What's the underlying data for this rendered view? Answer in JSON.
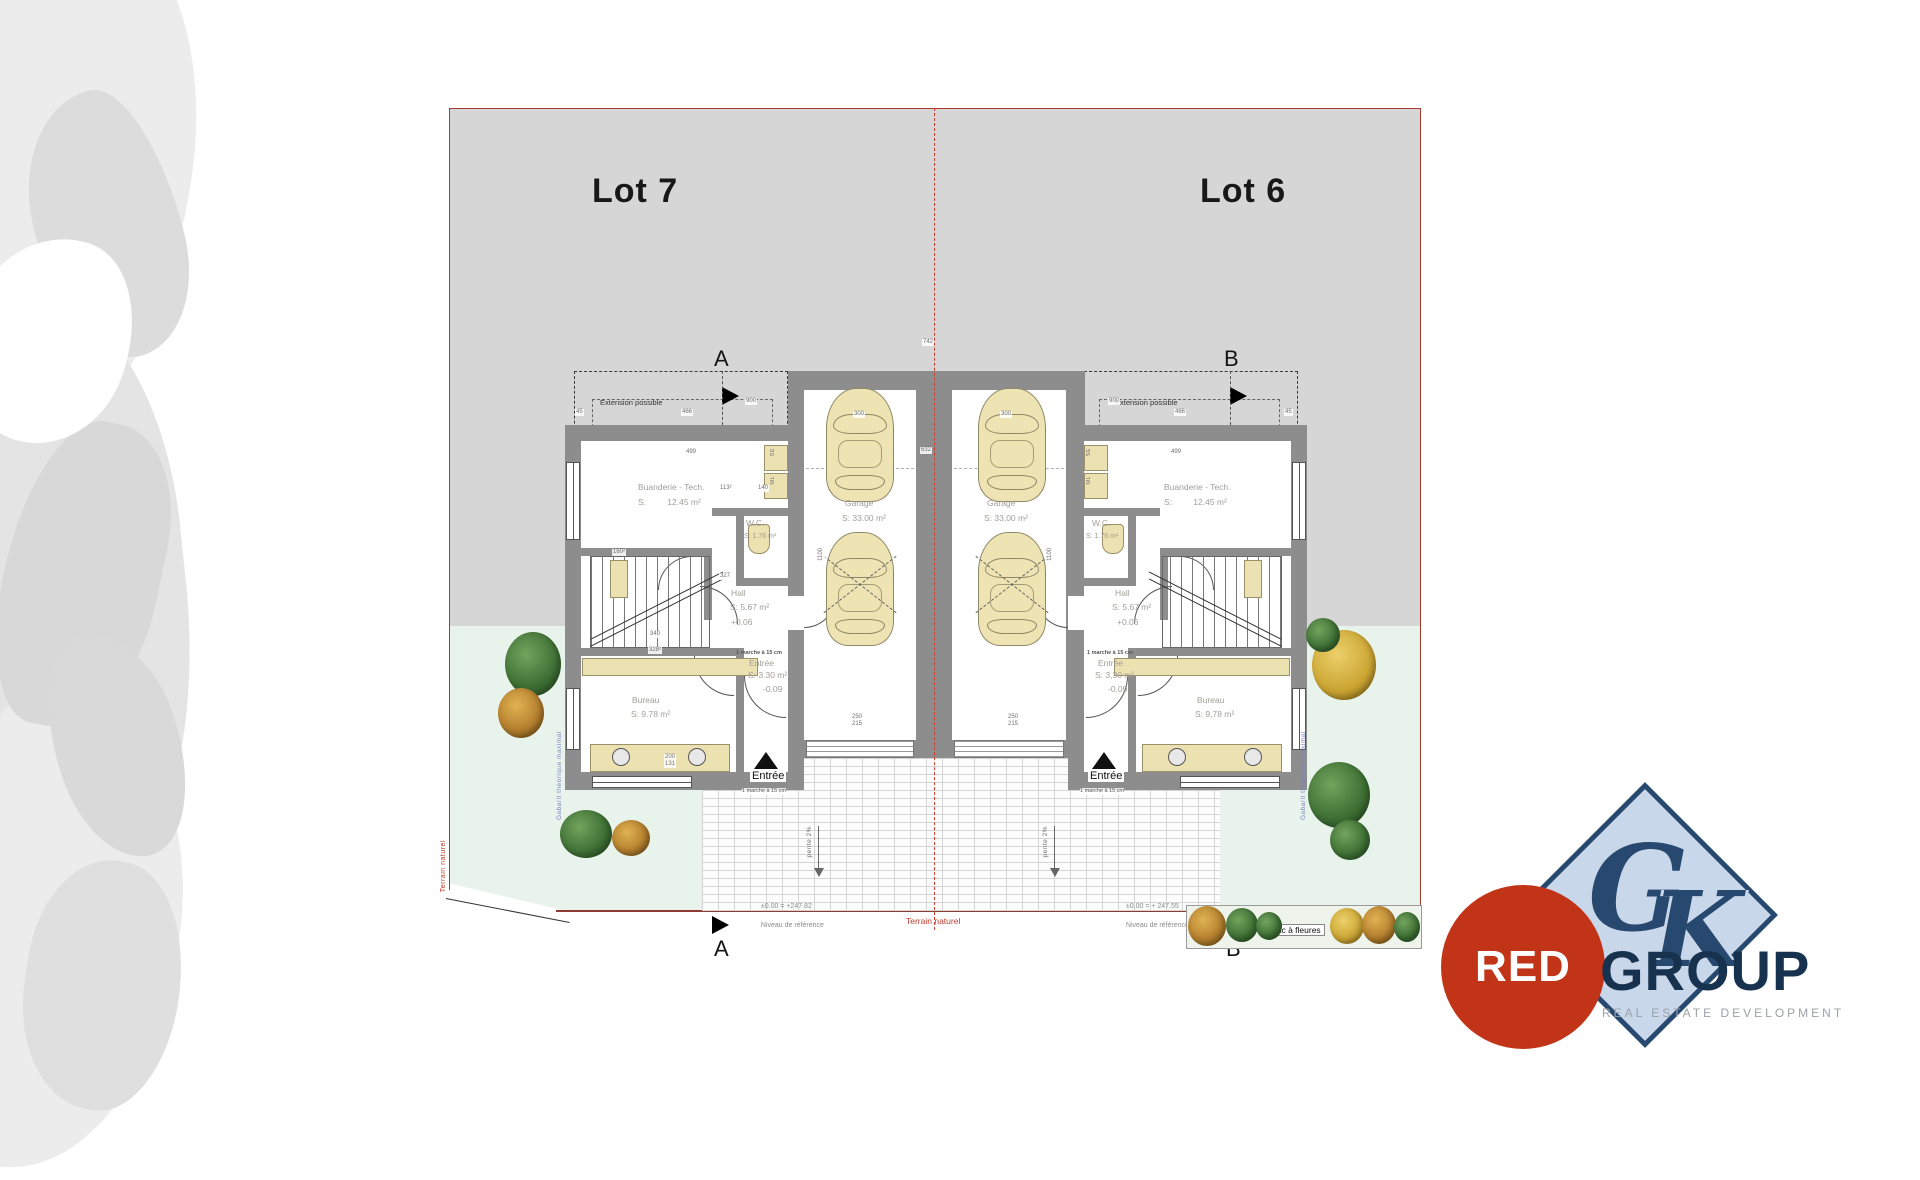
{
  "lots": {
    "left": "Lot 7",
    "right": "Lot 6"
  },
  "section_markers": {
    "top_left": "A",
    "top_right": "B",
    "bottom_left": "A",
    "bottom_right": "B"
  },
  "extension": {
    "label_left": "Extension possible",
    "label_right": "Extension possible"
  },
  "left_unit": {
    "buanderie": {
      "name": "Buanderie - Tech.",
      "area": "S:         12.45 m²"
    },
    "wc": {
      "name": "W.C.",
      "area": "S: 1.76 m²"
    },
    "hall": {
      "name": "Hall",
      "area": "S: 5.67 m²",
      "level": "+0.06"
    },
    "stair_note": "1 marche à 15 cm",
    "entree": {
      "name": "Entrée",
      "area": "S: 3.30 m²",
      "level": "-0.09"
    },
    "bureau": {
      "name": "Bureau",
      "area": "S: 9.78 m²"
    },
    "garage": {
      "name": "Garage",
      "area": "S: 33.00 m²"
    },
    "appliance_se": "SE",
    "appliance_ml": "ML",
    "porch_label": "Entrée",
    "porch_note": "1 marche à 15 cm"
  },
  "right_unit": {
    "buanderie": {
      "name": "Buanderie - Tech.",
      "area": "S:         12.45 m²"
    },
    "wc": {
      "name": "W.C.",
      "area": "S: 1.76 m²"
    },
    "hall": {
      "name": "Hall",
      "area": "S: 5.67 m²",
      "level": "+0.06"
    },
    "stair_note": "1 marche à 15 cm",
    "entree": {
      "name": "Entrée",
      "area": "S: 3,30 m²",
      "level": "-0.09"
    },
    "bureau": {
      "name": "Bureau",
      "area": "S: 9,78 m²"
    },
    "garage": {
      "name": "Garage",
      "area": "S: 33,00 m²"
    },
    "appliance_se": "SE",
    "appliance_ml": "ML",
    "porch_label": "Entrée",
    "porch_note": "1 marche à 15 cm"
  },
  "site": {
    "level_left_1": "±0.00 = +247.82",
    "level_left_2": "Niveau de référence",
    "level_right_1": "±0.00 = + 247.55",
    "level_right_2": "Niveau de référence",
    "terrain_bottom": "Terrain naturel",
    "terrain_left": "Terrain naturel",
    "slope_left": "pente 2%",
    "slope_right": "pente 2%",
    "planter": "bac à fleures",
    "gabarit_left": "Gabarit théorique maximal",
    "gabarit_right": "Gabarit théorique maximal"
  },
  "dims": [
    {
      "t": "742"
    },
    {
      "t": "900"
    },
    {
      "t": "466"
    },
    {
      "t": "45"
    },
    {
      "t": "499"
    },
    {
      "t": "900"
    },
    {
      "t": "466"
    },
    {
      "t": "45"
    },
    {
      "t": "499"
    },
    {
      "t": "300"
    },
    {
      "t": "300"
    },
    {
      "t": "632"
    },
    {
      "t": "1100"
    },
    {
      "t": "1100"
    },
    {
      "t": "160²"
    },
    {
      "t": "327"
    },
    {
      "t": "113²"
    },
    {
      "t": "140"
    },
    {
      "t": "340"
    },
    {
      "t": "328²"
    },
    {
      "t": "250"
    },
    {
      "t": "215"
    },
    {
      "t": "250"
    },
    {
      "t": "215"
    },
    {
      "t": "200"
    },
    {
      "t": "131"
    }
  ],
  "logo": {
    "monogram_g": "G",
    "monogram_k": "K",
    "red": "RED",
    "group": "GROUP",
    "tagline": "REAL ESTATE DEVELOPMENT"
  },
  "colors": {
    "lot_gray": "#d6d6d6",
    "garden_green": "#e8f3ec",
    "wall_gray": "#8d8d8d",
    "boundary_red": "#a93b2e",
    "centerline_red": "#d23b2f",
    "logo_navy": "#17324f",
    "logo_red": "#c23418",
    "diamond_blue": "#c9d7ea",
    "note_blue": "#7b87c6"
  }
}
